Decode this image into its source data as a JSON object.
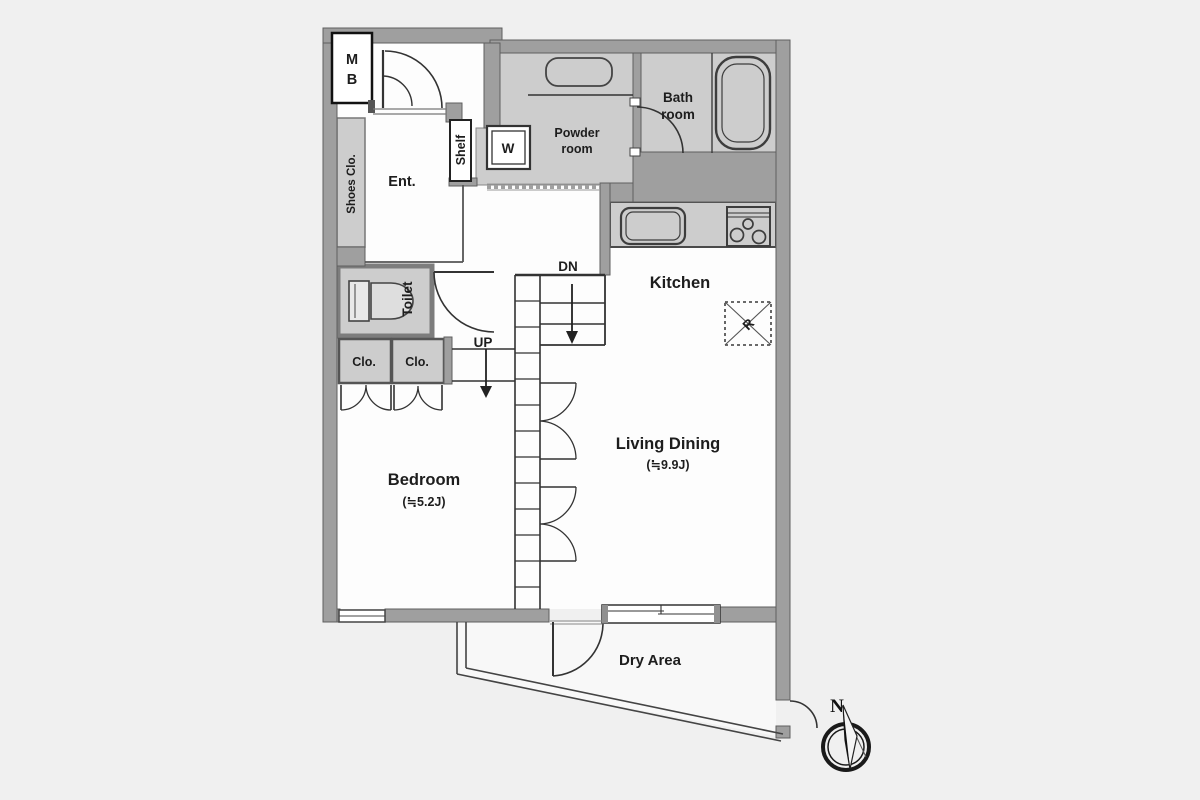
{
  "rooms": {
    "meter_box": {
      "line1": "M",
      "line2": "B"
    },
    "shoes_closet": {
      "label": "Shoes Clo."
    },
    "entrance": {
      "label": "Ent."
    },
    "shelf": {
      "label": "Shelf"
    },
    "washer": {
      "label": "W"
    },
    "powder_room": {
      "line1": "Powder",
      "line2": "room"
    },
    "bathroom": {
      "line1": "Bath",
      "line2": "room"
    },
    "toilet": {
      "label": "Toilet"
    },
    "kitchen": {
      "label": "Kitchen"
    },
    "living_dining": {
      "label": "Living Dining",
      "size": "(≒9.9J)"
    },
    "bedroom": {
      "label": "Bedroom",
      "size": "(≒5.2J)"
    },
    "closet_1": {
      "label": "Clo."
    },
    "closet_2": {
      "label": "Clo."
    },
    "dry_area": {
      "label": "Dry Area"
    }
  },
  "stairs": {
    "down_label": "DN",
    "up_label": "UP"
  },
  "appliances": {
    "refrigerator_label": "R"
  },
  "compass": {
    "north_label": "N"
  },
  "colors": {
    "background": "#f0f0f0",
    "wall_fill": "#9f9f9f",
    "wall_edge": "#5f5f5f",
    "room_fill": "#fdfdfd",
    "service_room_fill": "#cdcdcd",
    "line": "#333333",
    "text": "#1d1d1d"
  }
}
